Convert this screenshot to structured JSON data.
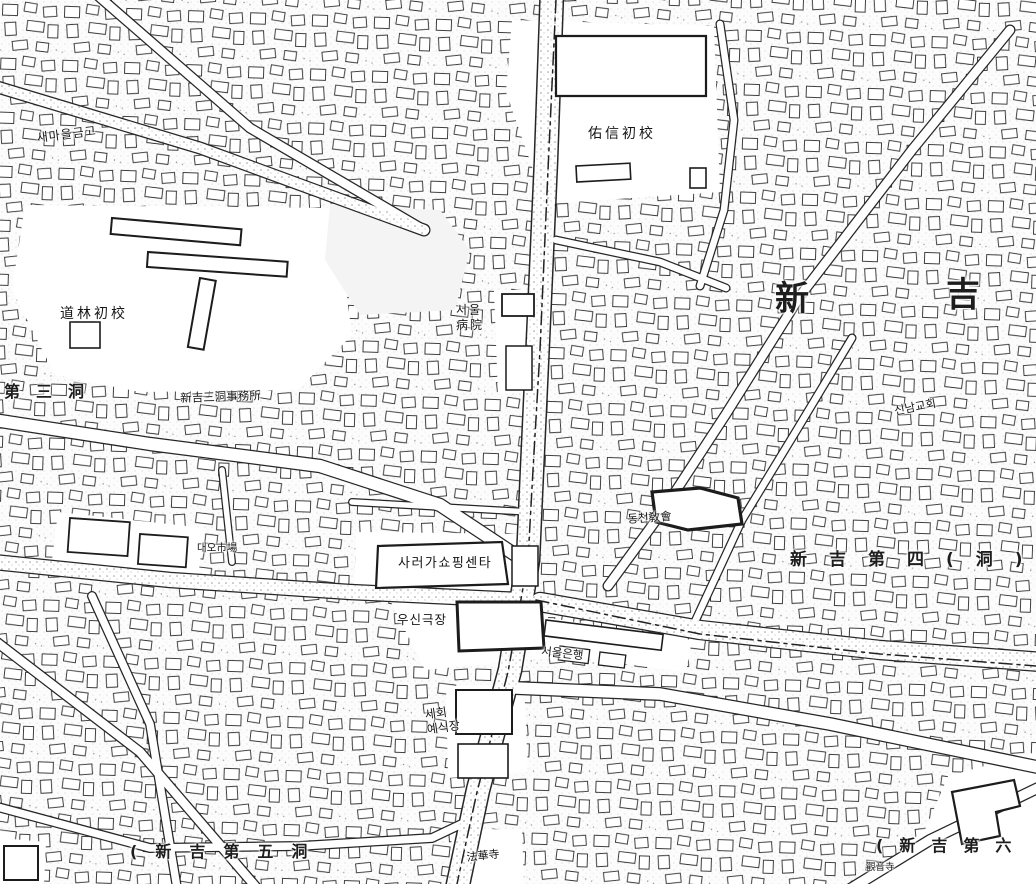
{
  "map": {
    "labels": {
      "saemaul_geumgo": "새마을금고",
      "dorim_elementary": "道林初校",
      "usin_elementary": "佑信初校",
      "seoul_hospital_line1": "서울",
      "seoul_hospital_line2": "病院",
      "singil3_office": "新吉三洞事務所",
      "sareoga_shopping_center": "사러가쇼핑센타",
      "usin_theater": "우신극장",
      "seoul_bank": "서울은행",
      "dongcheon_church": "동천敎會",
      "sinnam_church": "신남교회",
      "daeo_market": "대오市場",
      "sehoe_hall_line1": "세회",
      "sehoe_hall_line2": "예식장",
      "beophwa_temple": "法華寺",
      "gwaneum_temple": "觀音寺",
      "district_sin_big": "新",
      "district_gil_big": "吉",
      "district_3": "第三洞",
      "district_4": "新吉第四(洞)",
      "district_5": "(新吉第五洞",
      "district_6": "(新吉第六"
    },
    "ink_color": "#2b2b2b",
    "paper_color": "#fcfcfc"
  }
}
